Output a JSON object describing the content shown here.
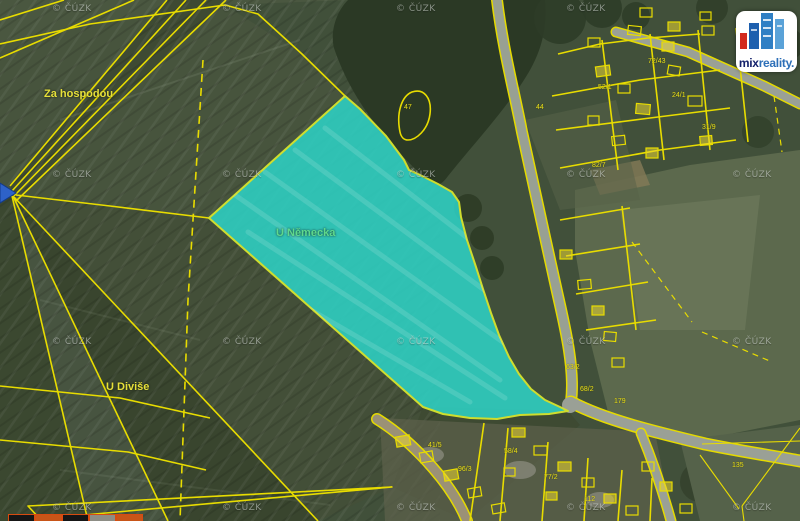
{
  "map": {
    "highlight_parcel": {
      "name": "U Německa",
      "fill": "#2ed0c4",
      "stroke": "#cfdd2e"
    },
    "boundary_color": "#e8dc00",
    "place_labels": [
      {
        "text": "Za hospodou",
        "x": 44,
        "y": 88,
        "color": "#e6e03a"
      },
      {
        "text": "U Německa",
        "x": 276,
        "y": 227,
        "color": "#5fd98c"
      },
      {
        "text": "U Diviše",
        "x": 106,
        "y": 381,
        "color": "#e6e03a"
      }
    ],
    "watermark": {
      "text": "© ČÚZK",
      "positions": [
        [
          52,
          4
        ],
        [
          222,
          4
        ],
        [
          396,
          4
        ],
        [
          566,
          4
        ],
        [
          52,
          170
        ],
        [
          222,
          170
        ],
        [
          396,
          170
        ],
        [
          566,
          170
        ],
        [
          732,
          170
        ],
        [
          52,
          337
        ],
        [
          222,
          337
        ],
        [
          396,
          337
        ],
        [
          566,
          337
        ],
        [
          732,
          337
        ],
        [
          52,
          503
        ],
        [
          222,
          503
        ],
        [
          396,
          503
        ],
        [
          566,
          503
        ],
        [
          732,
          503
        ]
      ]
    },
    "parcel_labels": [
      {
        "text": "47",
        "x": 404,
        "y": 104
      },
      {
        "text": "44",
        "x": 536,
        "y": 104
      },
      {
        "text": "52/1",
        "x": 598,
        "y": 84
      },
      {
        "text": "72/43",
        "x": 648,
        "y": 58
      },
      {
        "text": "24/1",
        "x": 672,
        "y": 92
      },
      {
        "text": "31/9",
        "x": 702,
        "y": 124
      },
      {
        "text": "82/7",
        "x": 592,
        "y": 162
      },
      {
        "text": "63/2",
        "x": 566,
        "y": 364
      },
      {
        "text": "68/2",
        "x": 580,
        "y": 386
      },
      {
        "text": "179",
        "x": 614,
        "y": 398
      },
      {
        "text": "41/5",
        "x": 428,
        "y": 442
      },
      {
        "text": "58/4",
        "x": 504,
        "y": 448
      },
      {
        "text": "96/3",
        "x": 458,
        "y": 466
      },
      {
        "text": "77/2",
        "x": 544,
        "y": 474
      },
      {
        "text": "112",
        "x": 584,
        "y": 496
      },
      {
        "text": "135",
        "x": 732,
        "y": 462
      }
    ],
    "scale_bar_colors": [
      "#161616",
      "#c85518",
      "#161616",
      "#8d8d85",
      "#c85518"
    ]
  },
  "logo": {
    "brand_primary": "mix",
    "brand_secondary": "reality.",
    "building_blue": "#2f7fc4",
    "building_red": "#d32b1f"
  }
}
